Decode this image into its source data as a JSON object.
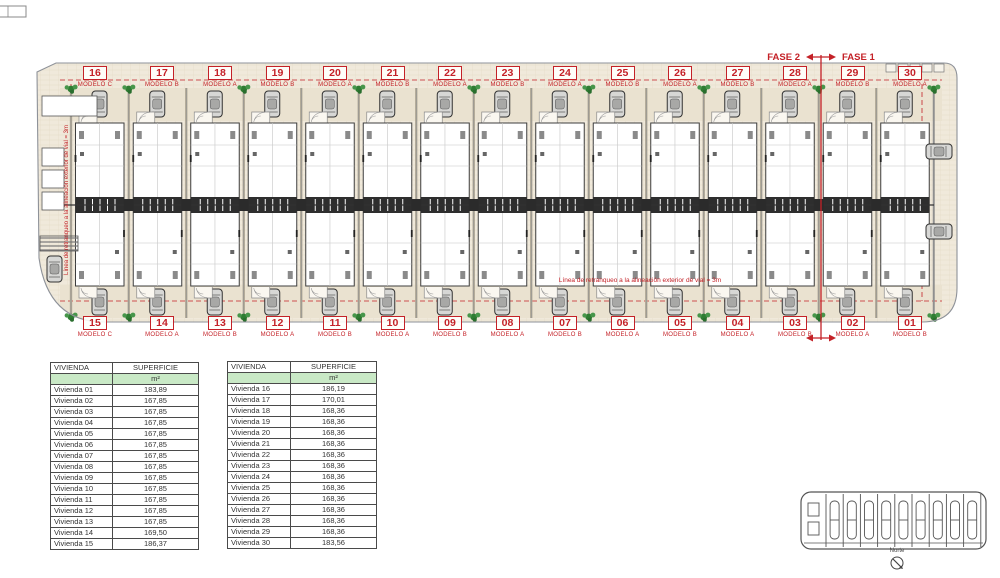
{
  "colors": {
    "annotation_red": "#c42127",
    "plan_beige": "#f0e9db",
    "table_header_green": "#c9e9c6",
    "plant_green": "#2f7d33",
    "line_dark": "#3d3d3d"
  },
  "phase_labels": {
    "left": "FASE 2",
    "right": "FASE 1"
  },
  "annotations": {
    "setback_note": "Línea de retranqueo a la alineación exterior de vial = 3m",
    "compass_label": "Norte"
  },
  "units_top": [
    {
      "number": "16",
      "model": "MODELO C"
    },
    {
      "number": "17",
      "model": "MODELO B"
    },
    {
      "number": "18",
      "model": "MODELO A"
    },
    {
      "number": "19",
      "model": "MODELO B"
    },
    {
      "number": "20",
      "model": "MODELO A"
    },
    {
      "number": "21",
      "model": "MODELO B"
    },
    {
      "number": "22",
      "model": "MODELO A"
    },
    {
      "number": "23",
      "model": "MODELO B"
    },
    {
      "number": "24",
      "model": "MODELO A"
    },
    {
      "number": "25",
      "model": "MODELO B"
    },
    {
      "number": "26",
      "model": "MODELO A"
    },
    {
      "number": "27",
      "model": "MODELO B"
    },
    {
      "number": "28",
      "model": "MODELO A"
    },
    {
      "number": "29",
      "model": "MODELO B"
    },
    {
      "number": "30",
      "model": "MODELO A"
    }
  ],
  "units_bottom": [
    {
      "number": "15",
      "model": "MODELO C"
    },
    {
      "number": "14",
      "model": "MODELO A"
    },
    {
      "number": "13",
      "model": "MODELO B"
    },
    {
      "number": "12",
      "model": "MODELO A"
    },
    {
      "number": "11",
      "model": "MODELO B"
    },
    {
      "number": "10",
      "model": "MODELO A"
    },
    {
      "number": "09",
      "model": "MODELO B"
    },
    {
      "number": "08",
      "model": "MODELO A"
    },
    {
      "number": "07",
      "model": "MODELO B"
    },
    {
      "number": "06",
      "model": "MODELO A"
    },
    {
      "number": "05",
      "model": "MODELO B"
    },
    {
      "number": "04",
      "model": "MODELO A"
    },
    {
      "number": "03",
      "model": "MODELO B"
    },
    {
      "number": "02",
      "model": "MODELO A"
    },
    {
      "number": "01",
      "model": "MODELO B"
    }
  ],
  "tables": [
    {
      "headers": [
        "VIVIENDA",
        "SUPERFICIE"
      ],
      "unit_label": "m²",
      "rows": [
        [
          "Vivienda 01",
          "183,89"
        ],
        [
          "Vivienda 02",
          "167,85"
        ],
        [
          "Vivienda 03",
          "167,85"
        ],
        [
          "Vivienda 04",
          "167,85"
        ],
        [
          "Vivienda 05",
          "167,85"
        ],
        [
          "Vivienda 06",
          "167,85"
        ],
        [
          "Vivienda 07",
          "167,85"
        ],
        [
          "Vivienda 08",
          "167,85"
        ],
        [
          "Vivienda 09",
          "167,85"
        ],
        [
          "Vivienda 10",
          "167,85"
        ],
        [
          "Vivienda 11",
          "167,85"
        ],
        [
          "Vivienda 12",
          "167,85"
        ],
        [
          "Vivienda 13",
          "167,85"
        ],
        [
          "Vivienda 14",
          "169,50"
        ],
        [
          "Vivienda 15",
          "186,37"
        ]
      ]
    },
    {
      "headers": [
        "VIVIENDA",
        "SUPERFICIE"
      ],
      "unit_label": "m²",
      "rows": [
        [
          "Vivienda 16",
          "186,19"
        ],
        [
          "Vivienda 17",
          "170,01"
        ],
        [
          "Vivienda 18",
          "168,36"
        ],
        [
          "Vivienda 19",
          "168,36"
        ],
        [
          "Vivienda 20",
          "168,36"
        ],
        [
          "Vivienda 21",
          "168,36"
        ],
        [
          "Vivienda 22",
          "168,36"
        ],
        [
          "Vivienda 23",
          "168,36"
        ],
        [
          "Vivienda 24",
          "168,36"
        ],
        [
          "Vivienda 25",
          "168,36"
        ],
        [
          "Vivienda 26",
          "168,36"
        ],
        [
          "Vivienda 27",
          "168,36"
        ],
        [
          "Vivienda 28",
          "168,36"
        ],
        [
          "Vivienda 29",
          "168,36"
        ],
        [
          "Vivienda 30",
          "183,56"
        ]
      ]
    }
  ]
}
